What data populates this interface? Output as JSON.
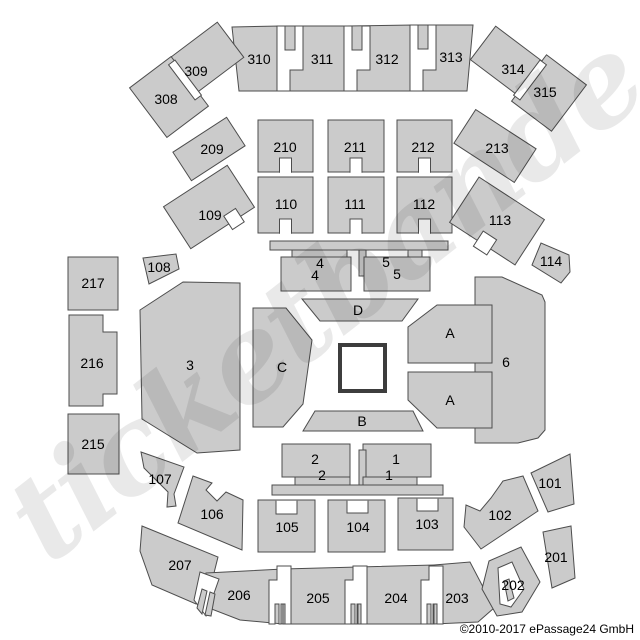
{
  "watermark": "ticketbande",
  "copyright": "©2010-2017 ePassage24 GmbH",
  "colors": {
    "fill": "#cbcbcb",
    "stroke": "#4d4d4d",
    "label": "#000000",
    "ring_stroke": "#3d3d3d",
    "bg": "#ffffff",
    "watermark_color": "rgba(0,0,0,0.088)"
  },
  "labels": {
    "s308": "308",
    "s309": "309",
    "s310": "310",
    "s311": "311",
    "s312": "312",
    "s313": "313",
    "s314": "314",
    "s315": "315",
    "s209": "209",
    "s210": "210",
    "s211": "211",
    "s212": "212",
    "s213": "213",
    "s108": "108",
    "s109": "109",
    "s110": "110",
    "s111": "111",
    "s112": "112",
    "s113": "113",
    "s114": "114",
    "s217": "217",
    "s216": "216",
    "s215": "215",
    "s101": "101",
    "s102": "102",
    "s103": "103",
    "s104": "104",
    "s105": "105",
    "s106": "106",
    "s107": "107",
    "s201": "201",
    "s202": "202",
    "s203": "203",
    "s204": "204",
    "s205": "205",
    "s206": "206",
    "s207": "207",
    "floor3": "3",
    "floor6": "6",
    "floorC": "C",
    "floorD": "D",
    "floorB": "B",
    "floorA_upper": "A",
    "floorA_lower": "A",
    "floor4_upper": "4",
    "floor4_lower": "4",
    "floor5_upper": "5",
    "floor5_lower": "5",
    "floor1_upper": "1",
    "floor1_lower": "1",
    "floor2_upper": "2",
    "floor2_lower": "2"
  }
}
